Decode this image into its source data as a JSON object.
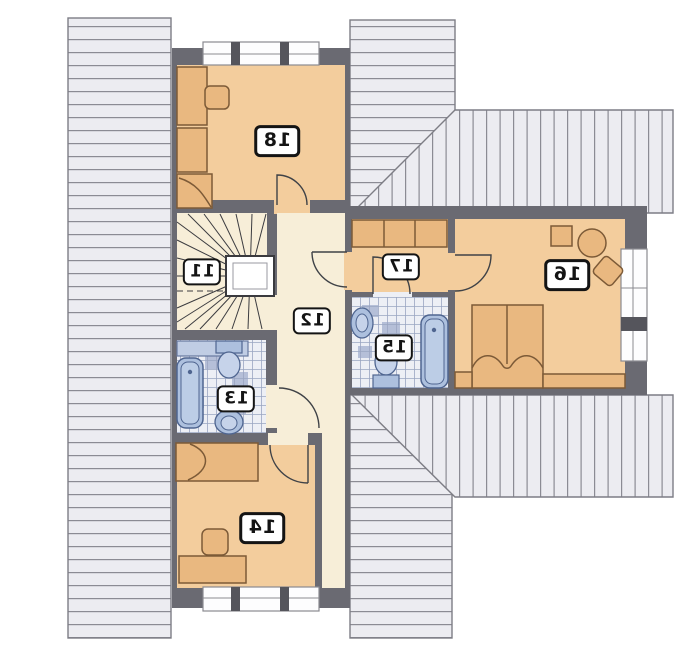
{
  "floor_plan": {
    "rooms": [
      {
        "label": "11"
      },
      {
        "label": "12"
      },
      {
        "label": "13"
      },
      {
        "label": "14"
      },
      {
        "label": "15"
      },
      {
        "label": "16"
      },
      {
        "label": "17"
      },
      {
        "label": "18"
      }
    ],
    "labels_mirrored": true,
    "colors": {
      "wall": "#6a6a72",
      "room_floor": "#f3cd9d",
      "hall_floor": "#f7eed8",
      "furniture": "#e9b880",
      "furniture_outline": "#7c5a37",
      "roof_fill": "#ececf1",
      "roof_line": "#8b8b94",
      "tile_bg": "#edeff5",
      "tile_line": "#9aa5c1",
      "fixture_blue": "#adc0de",
      "fixture_outline": "#53688f",
      "window_white": "#fdfdfe"
    }
  }
}
